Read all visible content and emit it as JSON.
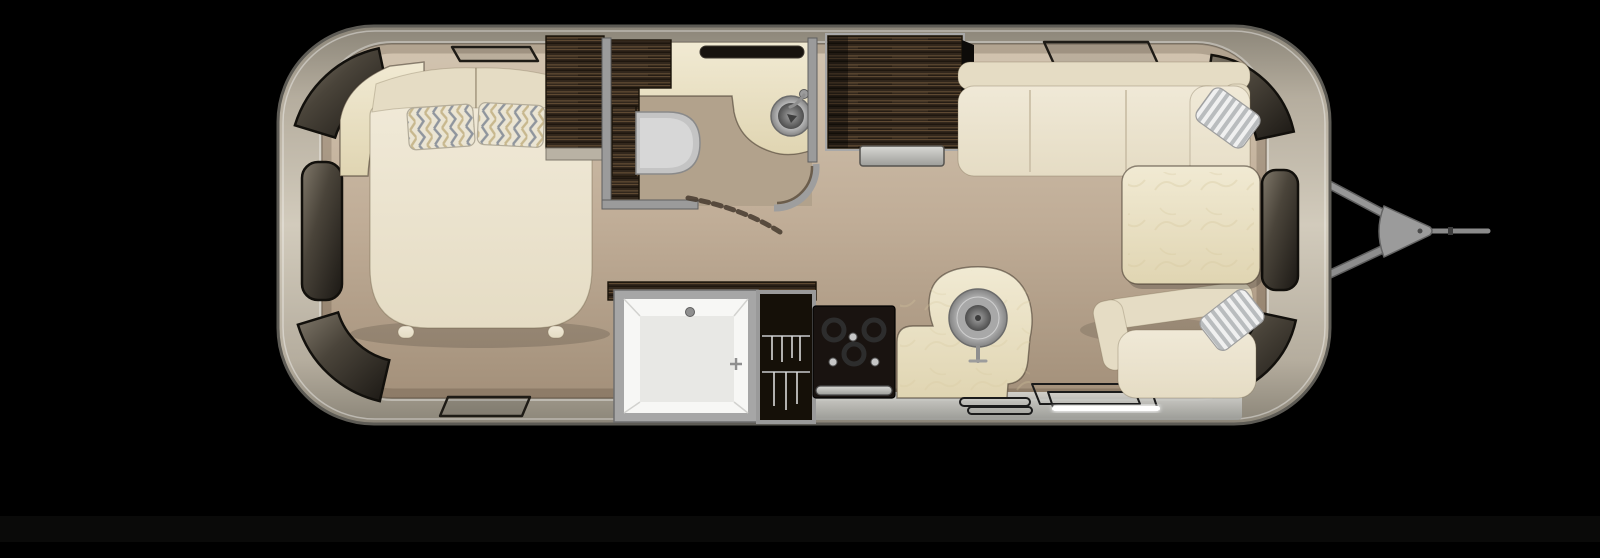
{
  "scene": {
    "title": "Travel trailer floor plan — top-down 3D render",
    "description": "Rounded aluminum trailer shell on black background, hitch pointing right",
    "rooms": [
      {
        "name": "bedroom",
        "position": "left",
        "items": [
          "corner-shelf",
          "bed",
          "headboard-cushions",
          "chevron-pillow-left",
          "chevron-pillow-right",
          "wardrobe"
        ]
      },
      {
        "name": "bathroom",
        "position": "top-center",
        "items": [
          "vanity-counter",
          "vanity-sink",
          "faucet",
          "toilet",
          "window-slot",
          "curved-door",
          "cabinets"
        ]
      },
      {
        "name": "galley",
        "position": "bottom-center",
        "items": [
          "shower",
          "hanging-closet",
          "range-oven",
          "kitchen-counter",
          "kitchen-sink",
          "entry-step",
          "led-strip"
        ]
      },
      {
        "name": "dinette",
        "position": "right",
        "items": [
          "sofa-l-shaped",
          "dinette-table",
          "rear-bench",
          "striped-pillow-top",
          "striped-pillow-bottom"
        ]
      }
    ],
    "exterior": [
      "shell",
      "curved-windows",
      "roof-vents",
      "a-frame-hitch",
      "coupler",
      "tow-bar"
    ]
  },
  "colors": {
    "bg": "#000000",
    "rim": "#5d5b55",
    "shellDark": "#8b8578",
    "shellMid": "#b5ad9e",
    "shellLight": "#d2cbbc",
    "floorLight": "#d2c4b0",
    "floorMid": "#c0ad97",
    "floorDark": "#a3907a",
    "wallMetal": "#9b9b9b",
    "tanBath": "#b2a28c",
    "cream": "#f0e9d7",
    "creamDark": "#e5dcc4",
    "seam": "#cfc4ac",
    "marble": "#f1ead3",
    "marbleDark": "#e0d5b2",
    "woodDark": "#32271c",
    "woodMid": "#5d4831",
    "woodLight": "#8a6b47",
    "glassLight": "#80786a",
    "glassMid": "#4a443a",
    "glassDark": "#1b1814",
    "metalLight": "#d8d8d8",
    "metalMid": "#9c9c9c",
    "metalDark": "#6b6b6b",
    "nearBlack": "#16110c",
    "white": "#f7f7f5",
    "led": "#ffffff",
    "stainlessLight": "#d8d8d4",
    "stainlessDark": "#9c9d99",
    "stripeLight": "#f0f0f0",
    "stripeDark": "#b9bcbe",
    "chevGray": "#8f959d",
    "chevTan": "#c8b88e",
    "pillowBase": "#ebe5d3"
  }
}
